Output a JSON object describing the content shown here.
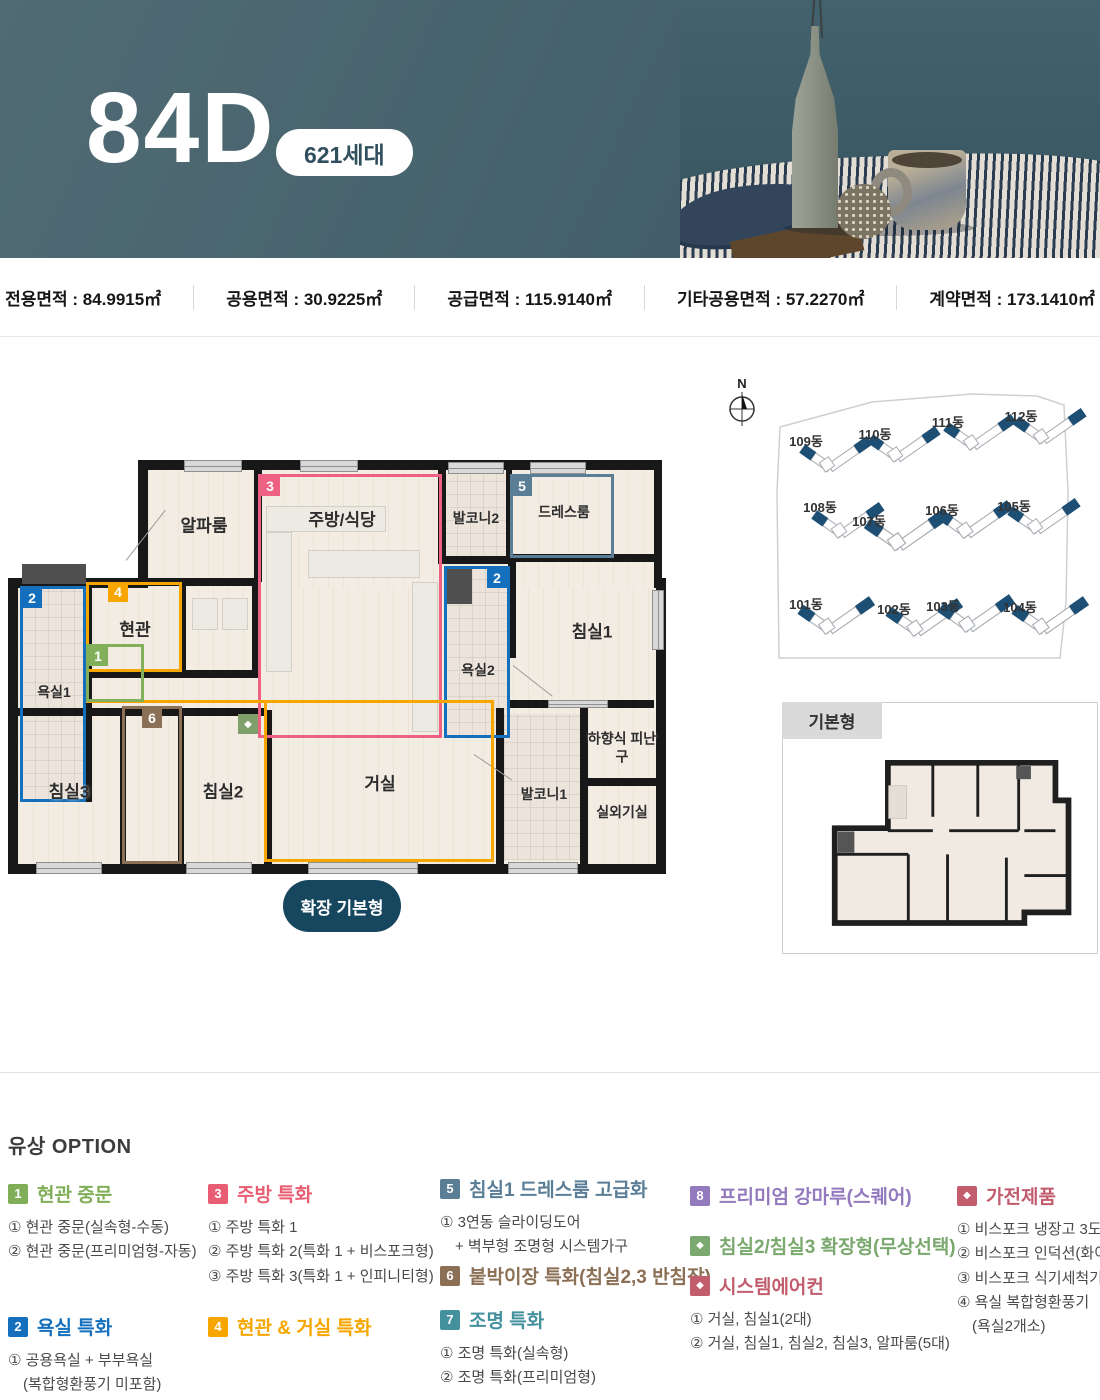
{
  "header": {
    "title": "84D",
    "badge": "621세대"
  },
  "area_bar": {
    "items": [
      "전용면적 : 84.9915㎡",
      "공용면적 : 30.9225㎡",
      "공급면적 : 115.9140㎡",
      "기타공용면적 : 57.2270㎡",
      "계약면적 : 173.1410㎡"
    ]
  },
  "plan": {
    "rooms": {
      "alpha": "알파룸",
      "kitchen": "주방/식당",
      "balcony2": "발코니2",
      "dress": "드레스룸",
      "bath2": "욕실2",
      "bed1": "침실1",
      "entrance": "현관",
      "bath1": "욕실1",
      "bed3": "침실3",
      "bed2": "침실2",
      "living": "거실",
      "balcony1": "발코니1",
      "escape": "하향식 피난구",
      "outdoor": "실외기실"
    },
    "badges": {
      "b1": "1",
      "b2": "2",
      "b3": "3",
      "b4": "4",
      "b5": "5",
      "b6": "6",
      "diamond": "◆"
    },
    "colors": {
      "badge1_green": "#82b05a",
      "badge2_blue": "#1470bc",
      "badge3_pink": "#ee6183",
      "badge4_orange": "#f7a600",
      "badge5_slate": "#5b7e97",
      "badge6_brown": "#8c7055",
      "living_orange": "#f7a600",
      "diamond_green": "#7fa06b"
    },
    "expand_button": "확장 기본형"
  },
  "site": {
    "compass_label": "N",
    "buildings": [
      {
        "label": "101동"
      },
      {
        "label": "102동"
      },
      {
        "label": "103동"
      },
      {
        "label": "104동"
      },
      {
        "label": "105동"
      },
      {
        "label": "106동"
      },
      {
        "label": "107동"
      },
      {
        "label": "108동"
      },
      {
        "label": "109동"
      },
      {
        "label": "110동"
      },
      {
        "label": "111동"
      },
      {
        "label": "112동"
      }
    ]
  },
  "basic_plan": {
    "label": "기본형"
  },
  "options": {
    "title": "유상 OPTION",
    "groups": [
      {
        "badge": "1",
        "color": "#7fae57",
        "title": "현관 중문",
        "items": [
          "① 현관 중문(실속형-수동)",
          "② 현관 중문(프리미엄형-자동)"
        ]
      },
      {
        "badge": "2",
        "color": "#1470bc",
        "title": "욕실 특화",
        "items": [
          "① 공용욕실 + 부부욕실",
          "　(복합형환풍기 미포함)"
        ]
      },
      {
        "badge": "3",
        "color": "#e85d72",
        "title": "주방 특화",
        "items": [
          "① 주방 특화 1",
          "② 주방 특화 2(특화 1 + 비스포크형)",
          "③ 주방 특화 3(특화 1 + 인피니티형)"
        ]
      },
      {
        "badge": "4",
        "color": "#f7a600",
        "title": "현관 & 거실 특화",
        "items": []
      },
      {
        "badge": "5",
        "color": "#5b7e97",
        "title": "침실1 드레스룸 고급화",
        "items": [
          "① 3연동 슬라이딩도어",
          "　+ 벽부형 조명형 시스템가구"
        ]
      },
      {
        "badge": "6",
        "color": "#8c7055",
        "title": "붙박이장 특화(침실2,3 반침장)",
        "items": []
      },
      {
        "badge": "7",
        "color": "#44919e",
        "title": "조명 특화",
        "items": [
          "① 조명 특화(실속형)",
          "② 조명 특화(프리미엄형)"
        ]
      },
      {
        "badge": "8",
        "color": "#9379bd",
        "title": "프리미엄 강마루(스퀘어)",
        "items": []
      },
      {
        "badge": "◆",
        "color": "#7aa86e",
        "title": "침실2/침실3 확장형(무상선택)",
        "items": []
      },
      {
        "badge": "◆",
        "color": "#c25d6e",
        "title": "시스템에어컨",
        "items": [
          "① 거실, 침실1(2대)",
          "② 거실, 침실1, 침실2, 침실3, 알파룸(5대)"
        ]
      },
      {
        "badge": "◆",
        "color": "#c25d6e",
        "title": "가전제품",
        "items": [
          "① 비스포크 냉장고 3도어",
          "② 비스포크 인덕션(화이트)",
          "③ 비스포크 식기세척기",
          "④ 욕실 복합형환풍기",
          "　(욕실2개소)"
        ]
      }
    ]
  }
}
